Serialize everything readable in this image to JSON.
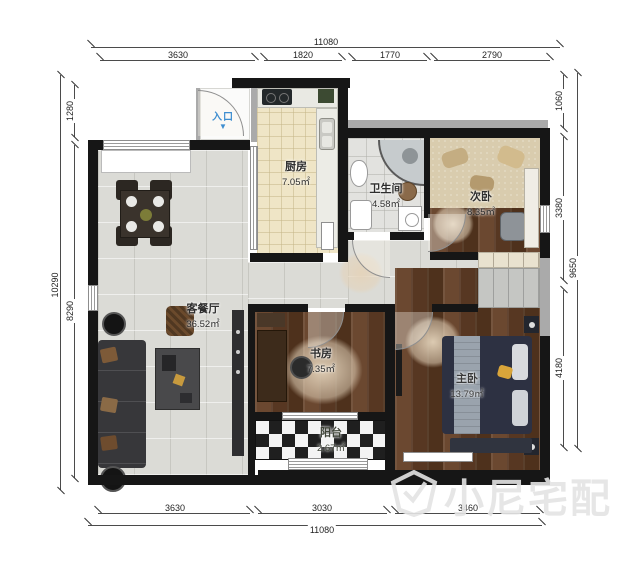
{
  "entrance": {
    "label": "入口",
    "arrow": "▼"
  },
  "rooms": {
    "kitchen": {
      "name": "厨房",
      "area": "7.05㎡"
    },
    "bathroom": {
      "name": "卫生间",
      "area": "4.58㎡"
    },
    "second_bedroom": {
      "name": "次卧",
      "area": "8.35㎡"
    },
    "living_dining": {
      "name": "客餐厅",
      "area": "36.52㎡"
    },
    "study": {
      "name": "书房",
      "area": "7.35㎡"
    },
    "master_bedroom": {
      "name": "主卧",
      "area": "13.79㎡"
    },
    "balcony": {
      "name": "阳台",
      "area": "2.67㎡"
    }
  },
  "dimensions": {
    "top": {
      "total": "11080",
      "segments": [
        "3630",
        "1820",
        "1770",
        "2790"
      ]
    },
    "bottom": {
      "total": "11080",
      "segments": [
        "3630",
        "3030",
        "3460"
      ]
    },
    "left": {
      "total": "10290",
      "segments": [
        "1280",
        "8290"
      ]
    },
    "right": {
      "total": "9650",
      "segments": [
        "1060",
        "3380",
        "4180"
      ]
    }
  },
  "watermark": {
    "text": "小尼宅配"
  },
  "colors": {
    "wall": "#161616",
    "entrance_accent": "#3e8ed0",
    "wood_floor": "#5e3d26",
    "kitchen_tile": "#efe5c6",
    "living_tile": "#dbdbd6",
    "carpet": "#d9ccae"
  }
}
